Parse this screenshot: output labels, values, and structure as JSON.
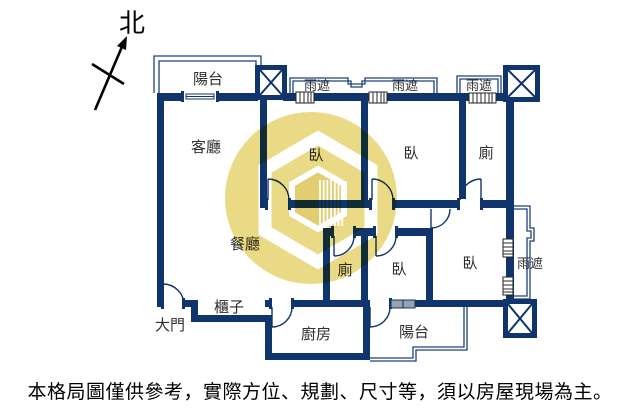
{
  "compass": {
    "north_label": "北"
  },
  "floor_plan": {
    "labels": {
      "living_room": "客廳",
      "dining_room": "餐廳",
      "kitchen": "廚房",
      "bedroom": "臥",
      "bathroom": "廁",
      "balcony": "陽台",
      "rain_shield": "雨遮",
      "main_door": "大門",
      "cabinet": "櫃子"
    },
    "colors": {
      "wall_navy": "#10356d",
      "watermark_yellow": "#e8d578",
      "window_gray": "#99a1ab"
    }
  },
  "disclaimer": "本格局圖僅供參考，實際方位、規劃、尺寸等，須以房屋現場為主。"
}
